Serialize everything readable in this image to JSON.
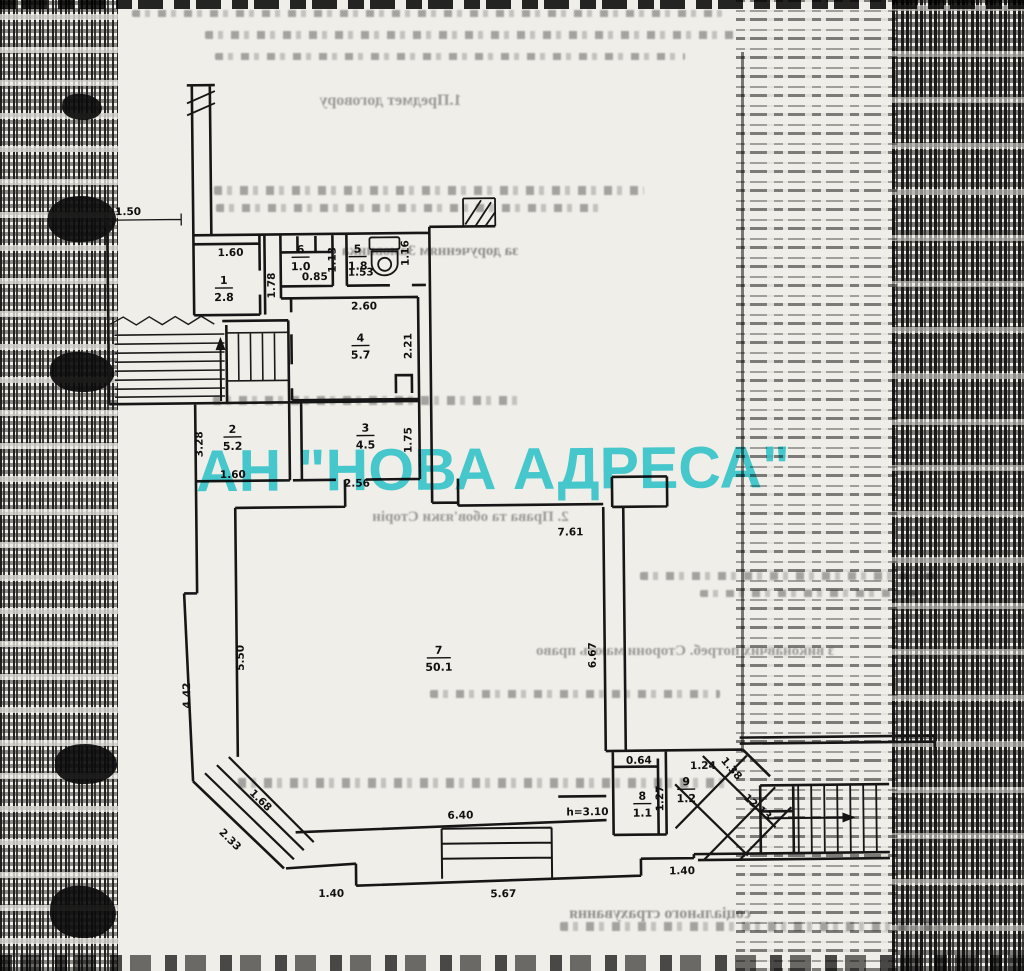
{
  "watermark": {
    "text": "АН \"НОВА АДРЕСА\"",
    "color": "#49d5e0"
  },
  "bleedthrough": {
    "heading1": "1.Предмет договору",
    "line_customer": "за дорученням Замовника",
    "heading2": "2. Права та обов'язки Сторін",
    "line_needs": "з виконавчих потреб. Сторони мають право",
    "line_insurance": "соціального страхування"
  },
  "plan": {
    "rooms": [
      {
        "number": "1",
        "area": "2.8"
      },
      {
        "number": "6",
        "area": "1.0"
      },
      {
        "number": "5",
        "area": "1.8"
      },
      {
        "number": "4",
        "area": "5.7"
      },
      {
        "number": "2",
        "area": "5.2"
      },
      {
        "number": "3",
        "area": "4.5"
      },
      {
        "number": "7",
        "area": "50.1"
      },
      {
        "number": "8",
        "area": "1.1"
      },
      {
        "number": "9",
        "area": "1.2"
      }
    ],
    "dims": [
      {
        "v": "1.50"
      },
      {
        "v": "1.60"
      },
      {
        "v": "1.78"
      },
      {
        "v": "0.85"
      },
      {
        "v": "1.13"
      },
      {
        "v": "1.53"
      },
      {
        "v": "1.16"
      },
      {
        "v": "2.60"
      },
      {
        "v": "2.21"
      },
      {
        "v": "3.28"
      },
      {
        "v": "1.60"
      },
      {
        "v": "1.75"
      },
      {
        "v": "2.56"
      },
      {
        "v": "7.61"
      },
      {
        "v": "5.50"
      },
      {
        "v": "4.42"
      },
      {
        "v": "6.67"
      },
      {
        "v": "h=3.10"
      },
      {
        "v": "0.64"
      },
      {
        "v": "1.27"
      },
      {
        "v": "1.24"
      },
      {
        "v": "1.38"
      },
      {
        "v": "12.13"
      },
      {
        "v": "1.68"
      },
      {
        "v": "2.33"
      },
      {
        "v": "6.40"
      },
      {
        "v": "1.40"
      },
      {
        "v": "5.67"
      },
      {
        "v": "1.40"
      }
    ]
  }
}
